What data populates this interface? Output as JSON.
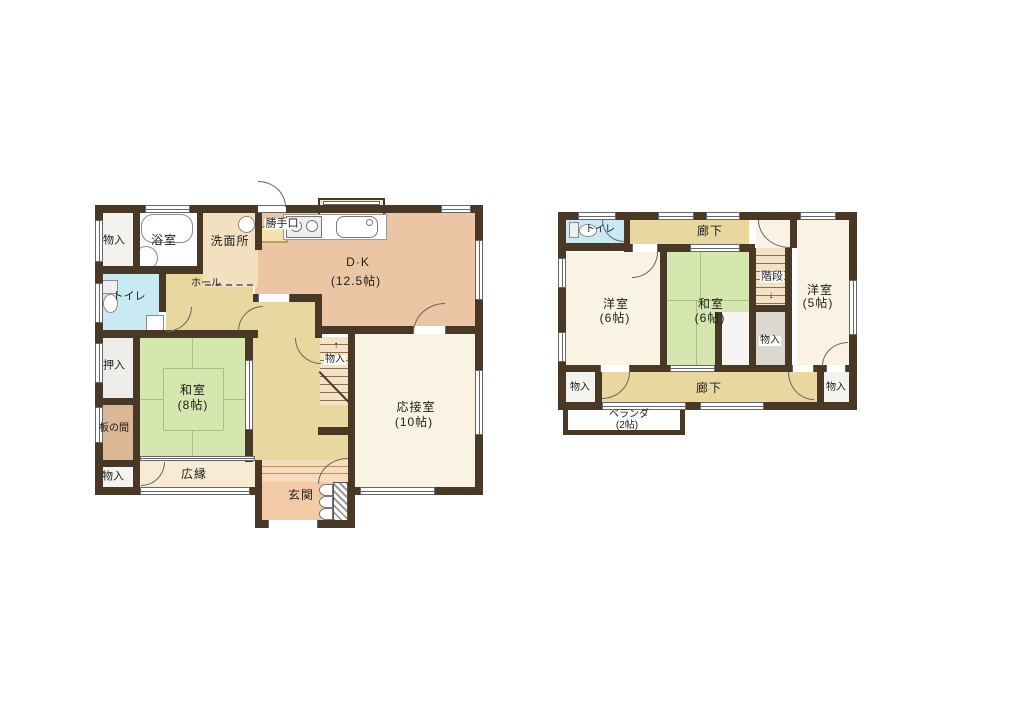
{
  "plan_type": "floor-plan",
  "palette": {
    "wall": "#4a3827",
    "dk_salmon": "#ecc5a4",
    "hall_tan": "#e8d79f",
    "tatami_green": "#d5e6ae",
    "cream_room": "#faf3e3",
    "toilet_blue": "#c9eaf2",
    "genkan_peach": "#f2cba6",
    "itanoma_tan": "#dbb795"
  },
  "f1": {
    "storage_tl": "物入",
    "bath": "浴室",
    "wash": "洗面所",
    "backdoor": "勝手口",
    "dk": "D·K",
    "dk_size": "(12.5帖)",
    "hall": "ホール",
    "toilet": "トイレ",
    "oshiire": "押入",
    "washitsu": "和室",
    "washitsu_size": "(8帖)",
    "itanoma": "板の間",
    "storage_bl": "物入",
    "hiroen": "広縁",
    "genkan": "玄関",
    "storage_stairs": "物入",
    "reception": "応接室",
    "reception_size": "(10帖)",
    "stairs_arrow": "↑"
  },
  "f2": {
    "toilet": "トイレ",
    "corridor_top": "廊下",
    "west6": "洋室",
    "west6_size": "(6帖)",
    "jp6": "和室",
    "jp6_size": "(6帖)",
    "stairs": "階段",
    "stairs_arrow": "↓",
    "west5": "洋室",
    "west5_size": "(5帖)",
    "storage_mid": "物入",
    "storage_bl": "物入",
    "corridor_bottom": "廊下",
    "storage_br": "物入",
    "veranda": "ベランダ",
    "veranda_size": "(2帖)"
  }
}
